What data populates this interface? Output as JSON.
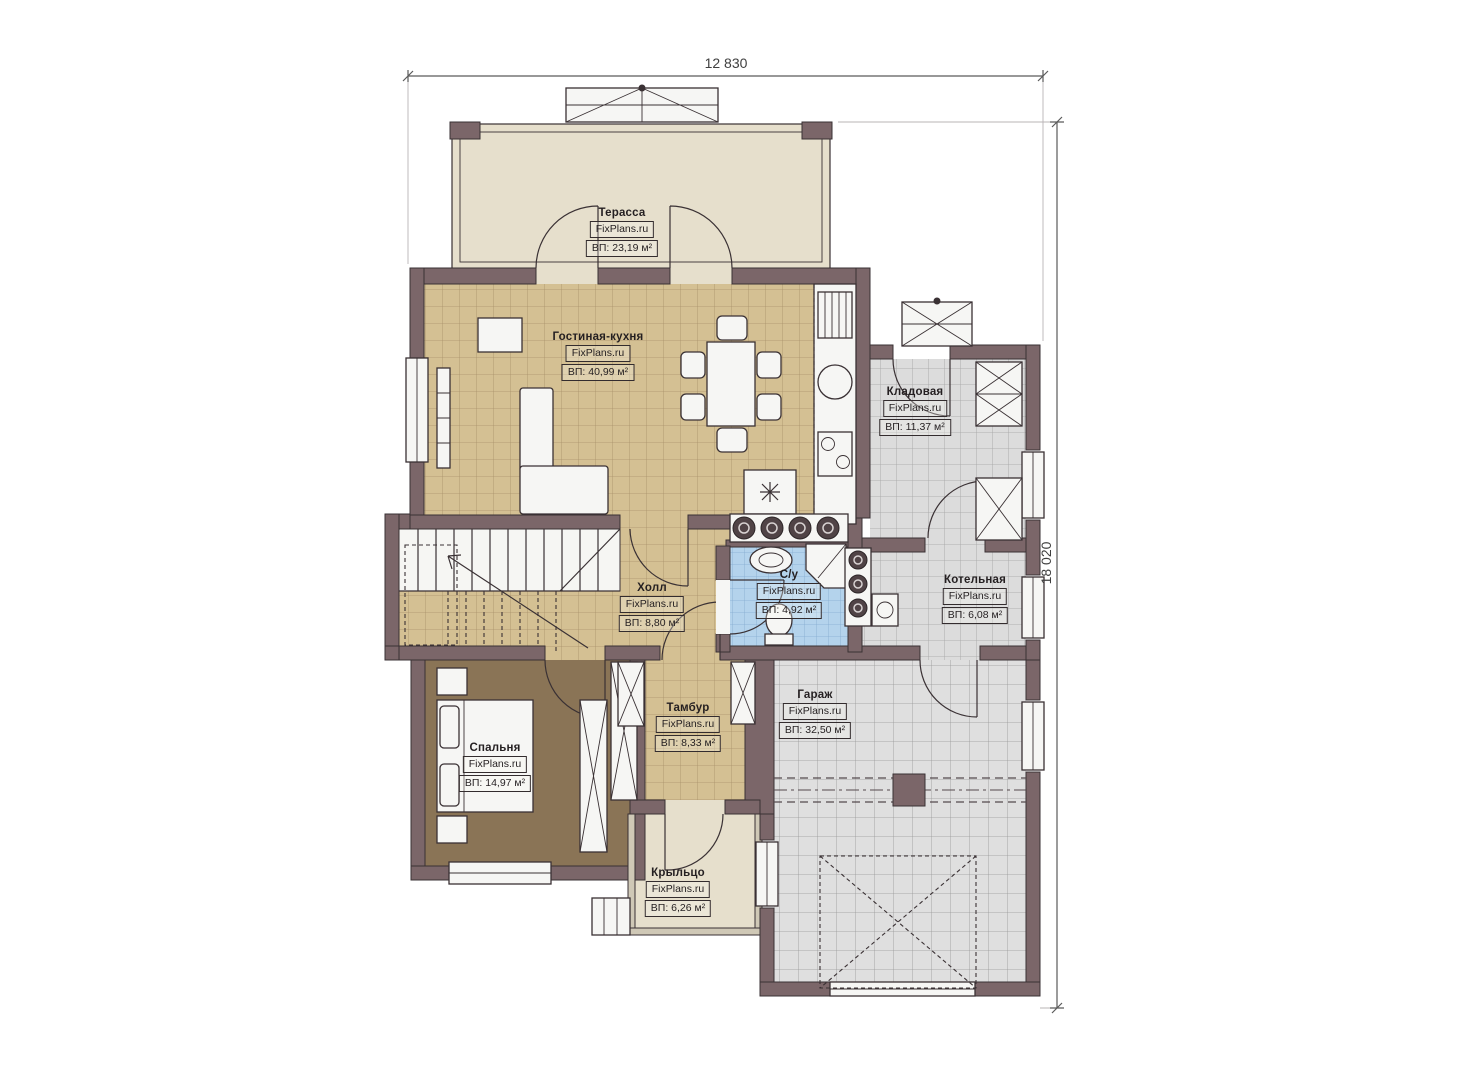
{
  "watermark": "FixPlans.ru",
  "dimensions": {
    "width_label": "12 830",
    "height_label": "18 020"
  },
  "rooms": [
    {
      "id": "terrace",
      "name": "Терасса",
      "area": "ВП: 23,19 м²"
    },
    {
      "id": "living_kitchen",
      "name": "Гостиная-кухня",
      "area": "ВП: 40,99 м²"
    },
    {
      "id": "storage",
      "name": "Кладовая",
      "area": "ВП: 11,37 м²"
    },
    {
      "id": "hall",
      "name": "Холл",
      "area": "ВП: 8,80 м²"
    },
    {
      "id": "bathroom",
      "name": "С/у",
      "area": "ВП: 4,92 м²"
    },
    {
      "id": "boiler_room",
      "name": "Котельная",
      "area": "ВП: 6,08 м²"
    },
    {
      "id": "bedroom",
      "name": "Спальня",
      "area": "ВП: 14,97 м²"
    },
    {
      "id": "vestibule",
      "name": "Тамбур",
      "area": "ВП: 8,33 м²"
    },
    {
      "id": "garage",
      "name": "Гараж",
      "area": "ВП: 32,50 м²"
    },
    {
      "id": "porch",
      "name": "Крыльцо",
      "area": "ВП: 6,26 м²"
    }
  ],
  "colors": {
    "wall": "#7b6669",
    "wall-outline": "#3a3134",
    "tile-tan": "#d4c093",
    "tile-grey": "#dcdcdc",
    "tile-blue": "#b4d3ec",
    "tile-garage": "#dfdfdf",
    "terrace-beige": "#e6dfcc",
    "bedroom-brown": "#8a7456",
    "fixture-white": "#f6f6f4"
  }
}
